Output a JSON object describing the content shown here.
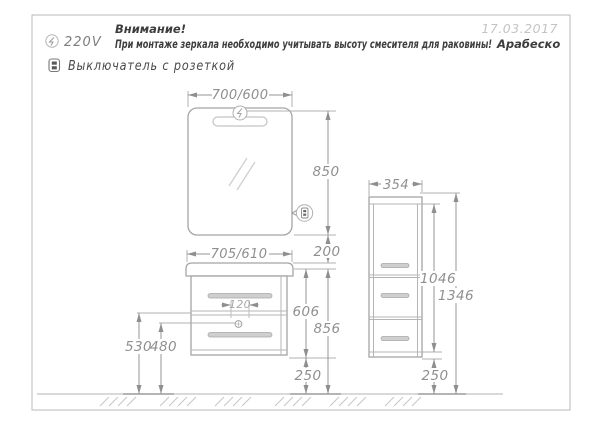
{
  "header": {
    "attention_title": "Внимание!",
    "warning_text": "При монтаже зеркала необходимо учитывать высоту смесителя для раковины!",
    "model_name": "Арабеско",
    "date": "17.03.2017",
    "voltage_label": "220V",
    "switch_legend": "Выключатель с розеткой"
  },
  "mirror": {
    "width": "700/600",
    "height": "850"
  },
  "vanity": {
    "width": "705/610",
    "height": "606",
    "total_height": "856",
    "bottom_gap": "250",
    "gap_to_mirror": "200",
    "siphon_offset": "120",
    "drain_height": "530",
    "socket_height": "480"
  },
  "tall_cabinet": {
    "width": "354",
    "body_height": "1046",
    "total_height": "1346",
    "bottom_gap": "250"
  }
}
